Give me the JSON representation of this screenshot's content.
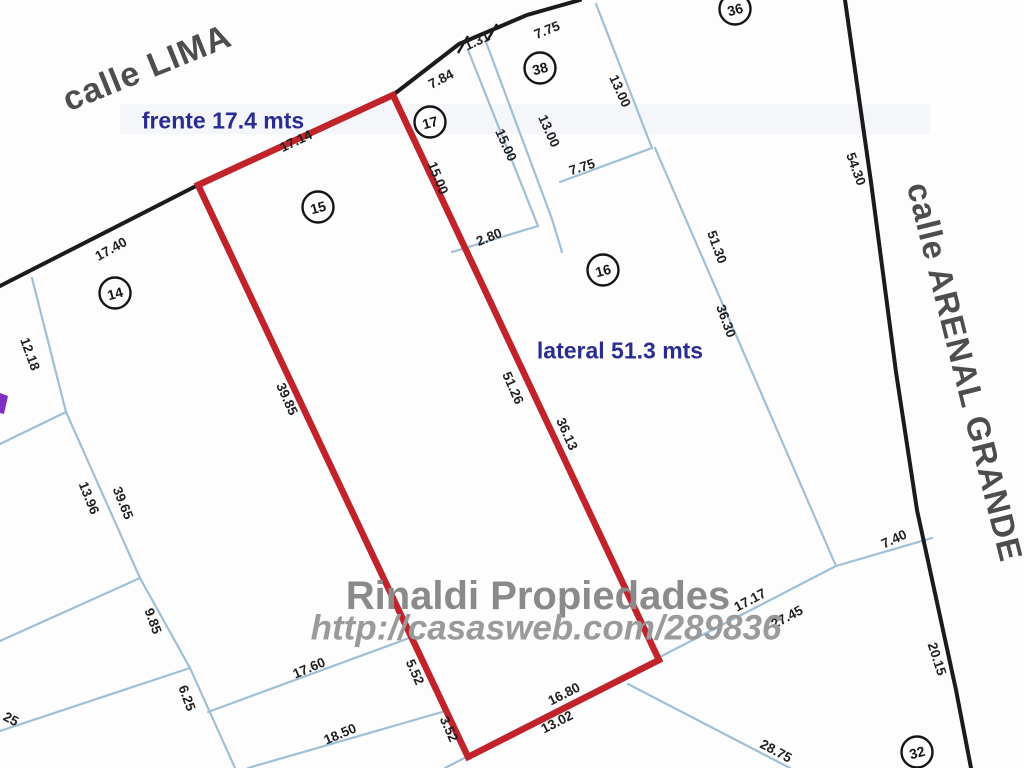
{
  "document_type": "cadastral plot plan",
  "colors": {
    "background": "#fdfdfd",
    "red_highlight": "#c1232b",
    "parcel_line_blue": "#9fbfd6",
    "boundary_black": "#1b1b1b",
    "annotation_navy": "#2a2d8f",
    "street_gray": "#4d4d4d",
    "watermark_gray": "#8a8a8a",
    "purple_mark": "#7d2fc0"
  },
  "streets": {
    "lima": {
      "text": "calle LIMA",
      "x": 147,
      "y": 68,
      "rot": -22,
      "size": 34,
      "color": "#4d4d4d",
      "spacing": 1
    },
    "arenal": {
      "text": "calle ARENAL GRANDE",
      "x": 965,
      "y": 372,
      "rot": 76,
      "size": 33,
      "color": "#4d4d4d",
      "spacing": 1
    }
  },
  "annotations": {
    "frente": {
      "text": "frente 17.4 mts",
      "x": 223,
      "y": 121,
      "rot": 0,
      "size": 23,
      "color": "#2a2d8f"
    },
    "lateral": {
      "text": "lateral 51.3 mts",
      "x": 620,
      "y": 351,
      "rot": 0,
      "size": 23,
      "color": "#2a2d8f"
    }
  },
  "watermark": {
    "line1": {
      "text": "Rinaldi Propiedades",
      "x": 538,
      "y": 596,
      "rot": 0,
      "size": 40,
      "color": "#8a8a8a"
    },
    "line2": {
      "text": "http://casasweb.com/289836",
      "x": 546,
      "y": 628,
      "rot": 0,
      "size": 35,
      "color": "#9a9a9a"
    }
  },
  "highlighted_lot": {
    "number": "15",
    "frente_mts": "17.4",
    "lateral_mts": "51.3",
    "polygon": [
      [
        198,
        185
      ],
      [
        393,
        95
      ],
      [
        659,
        660
      ],
      [
        468,
        757
      ]
    ],
    "stroke_width": 6.5
  },
  "boundary_lines": [
    {
      "id": "lima-edge",
      "points": [
        [
          0,
          286
        ],
        [
          198,
          185
        ]
      ]
    },
    {
      "id": "lima-edge-upper",
      "points": [
        [
          393,
          95
        ],
        [
          459,
          44
        ],
        [
          527,
          15
        ],
        [
          580,
          0
        ]
      ]
    },
    {
      "id": "arenal-edge",
      "points": [
        [
          845,
          0
        ],
        [
          871,
          182
        ],
        [
          896,
          372
        ],
        [
          917,
          510
        ],
        [
          956,
          690
        ],
        [
          971,
          768
        ]
      ]
    }
  ],
  "tick_marks": [
    {
      "points": [
        [
          458,
          53
        ],
        [
          468,
          36
        ]
      ]
    },
    {
      "points": [
        [
          487,
          41
        ],
        [
          497,
          24
        ]
      ]
    }
  ],
  "parcel_lines": [
    {
      "points": [
        [
          32,
          278
        ],
        [
          66,
          412
        ],
        [
          140,
          578
        ],
        [
          190,
          668
        ],
        [
          235,
          768
        ]
      ]
    },
    {
      "points": [
        [
          66,
          412
        ],
        [
          0,
          444
        ]
      ]
    },
    {
      "points": [
        [
          140,
          578
        ],
        [
          0,
          641
        ]
      ]
    },
    {
      "points": [
        [
          190,
          668
        ],
        [
          0,
          731
        ]
      ]
    },
    {
      "points": [
        [
          208,
          712
        ],
        [
          412,
          637
        ]
      ]
    },
    {
      "points": [
        [
          248,
          768
        ],
        [
          442,
          712
        ]
      ]
    },
    {
      "points": [
        [
          445,
          768
        ],
        [
          836,
          566
        ]
      ]
    },
    {
      "points": [
        [
          836,
          566
        ],
        [
          932,
          538
        ]
      ]
    },
    {
      "points": [
        [
          628,
          684
        ],
        [
          790,
          768
        ]
      ]
    },
    {
      "points": [
        [
          468,
          50
        ],
        [
          538,
          226
        ]
      ]
    },
    {
      "points": [
        [
          486,
          42
        ],
        [
          552,
          219
        ]
      ]
    },
    {
      "points": [
        [
          452,
          252
        ],
        [
          538,
          226
        ]
      ]
    },
    {
      "points": [
        [
          552,
          219
        ],
        [
          562,
          252
        ]
      ]
    },
    {
      "points": [
        [
          596,
          4
        ],
        [
          652,
          148
        ]
      ]
    },
    {
      "points": [
        [
          652,
          148
        ],
        [
          560,
          182
        ]
      ]
    },
    {
      "points": [
        [
          655,
          148
        ],
        [
          836,
          566
        ]
      ]
    }
  ],
  "purple_mark": {
    "polygon": [
      [
        0,
        393
      ],
      [
        8,
        396
      ],
      [
        4,
        414
      ],
      [
        0,
        413
      ]
    ]
  },
  "smudge": {
    "x": 120,
    "y": 104,
    "w": 810,
    "h": 30,
    "color": "#e9eef4",
    "opacity": 0.45
  },
  "measurements": [
    {
      "t": "17.40",
      "x": 111,
      "y": 249,
      "r": -29
    },
    {
      "t": "17.14",
      "x": 296,
      "y": 141,
      "r": -25
    },
    {
      "t": "7.84",
      "x": 441,
      "y": 79,
      "r": -27
    },
    {
      "t": "1.31",
      "x": 477,
      "y": 41,
      "r": -25
    },
    {
      "t": "7.75",
      "x": 547,
      "y": 30,
      "r": -22
    },
    {
      "t": "15.00",
      "x": 506,
      "y": 145,
      "r": 66
    },
    {
      "t": "13.00",
      "x": 549,
      "y": 131,
      "r": 66
    },
    {
      "t": "13.00",
      "x": 620,
      "y": 91,
      "r": 66
    },
    {
      "t": "15.00",
      "x": 438,
      "y": 178,
      "r": 68
    },
    {
      "t": "7.75",
      "x": 582,
      "y": 167,
      "r": -18
    },
    {
      "t": "2.80",
      "x": 489,
      "y": 237,
      "r": -22
    },
    {
      "t": "51.30",
      "x": 717,
      "y": 247,
      "r": 70
    },
    {
      "t": "36.30",
      "x": 726,
      "y": 321,
      "r": 70
    },
    {
      "t": "54.30",
      "x": 856,
      "y": 169,
      "r": 70
    },
    {
      "t": "12.18",
      "x": 30,
      "y": 354,
      "r": 70
    },
    {
      "t": "13.96",
      "x": 89,
      "y": 498,
      "r": 68
    },
    {
      "t": "39.65",
      "x": 123,
      "y": 503,
      "r": 68
    },
    {
      "t": "39.85",
      "x": 287,
      "y": 399,
      "r": 66
    },
    {
      "t": "51.26",
      "x": 513,
      "y": 388,
      "r": 66
    },
    {
      "t": "36.13",
      "x": 567,
      "y": 434,
      "r": 66
    },
    {
      "t": "9.85",
      "x": 153,
      "y": 621,
      "r": 70
    },
    {
      "t": "6.25",
      "x": 187,
      "y": 698,
      "r": 70
    },
    {
      "t": "25",
      "x": 11,
      "y": 719,
      "r": 28
    },
    {
      "t": "17.60",
      "x": 309,
      "y": 668,
      "r": -23
    },
    {
      "t": "18.50",
      "x": 340,
      "y": 734,
      "r": -23
    },
    {
      "t": "5.52",
      "x": 415,
      "y": 672,
      "r": 66
    },
    {
      "t": "3.52",
      "x": 449,
      "y": 729,
      "r": 66
    },
    {
      "t": "16.80",
      "x": 564,
      "y": 694,
      "r": -27
    },
    {
      "t": "13.02",
      "x": 557,
      "y": 722,
      "r": -27
    },
    {
      "t": "17.17",
      "x": 750,
      "y": 600,
      "r": -28
    },
    {
      "t": "27.45",
      "x": 787,
      "y": 617,
      "r": -28
    },
    {
      "t": "7.40",
      "x": 894,
      "y": 539,
      "r": -25
    },
    {
      "t": "20.15",
      "x": 937,
      "y": 659,
      "r": 72
    },
    {
      "t": "28.75",
      "x": 776,
      "y": 751,
      "r": 28
    }
  ],
  "lot_circles": [
    {
      "n": "14",
      "x": 115,
      "y": 293
    },
    {
      "n": "15",
      "x": 318,
      "y": 207
    },
    {
      "n": "16",
      "x": 603,
      "y": 270
    },
    {
      "n": "17",
      "x": 430,
      "y": 122
    },
    {
      "n": "38",
      "x": 540,
      "y": 68
    },
    {
      "n": "36",
      "x": 735,
      "y": 9
    },
    {
      "n": "32",
      "x": 917,
      "y": 752
    }
  ]
}
